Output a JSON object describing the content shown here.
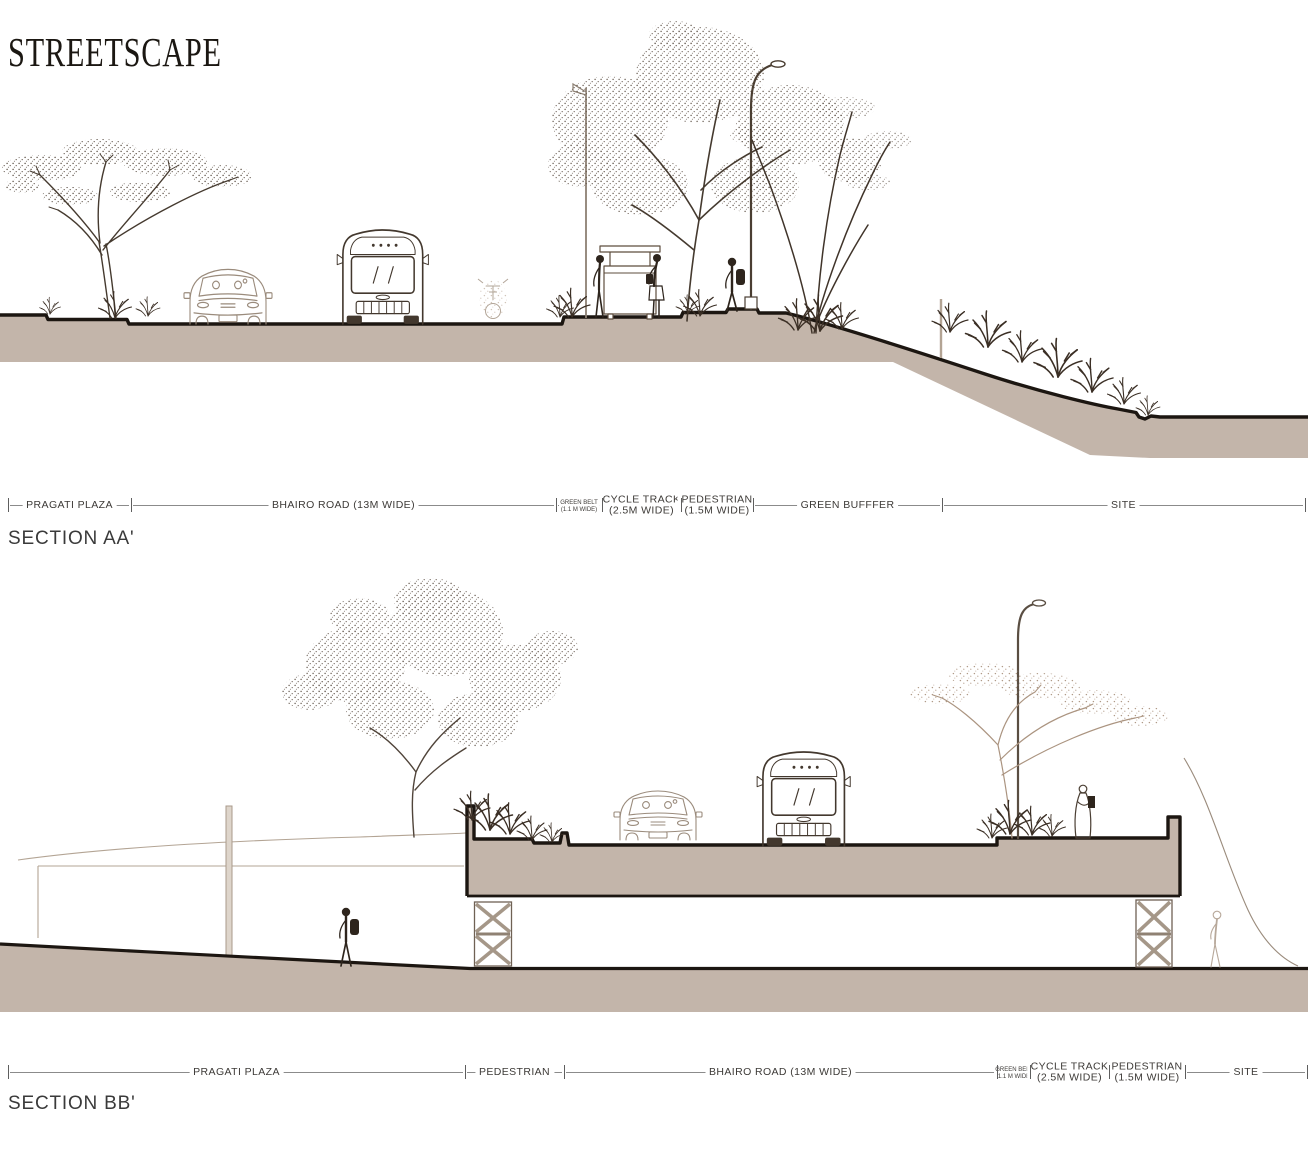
{
  "title": "STREETSCAPE",
  "palette": {
    "ground_fill": "#c3b5aa",
    "heavy_outline": "#1c1611",
    "sketch_dark": "#3b2f25",
    "sketch_light": "#b3a494",
    "label_text": "#3d3a37",
    "dim_line": "#8b8b8b"
  },
  "sections": [
    {
      "id": "AA",
      "heading": "SECTION AA'",
      "strip_y": 505,
      "segments": [
        {
          "label": "PRAGATI PLAZA",
          "x1": 8,
          "x2": 131
        },
        {
          "label": "BHAIRO ROAD (13M WIDE)",
          "x1": 131,
          "x2": 556
        },
        {
          "label": "GREEN BELT",
          "label2": "(1.1 M WIDE)",
          "size": "small",
          "x1": 556,
          "x2": 602
        },
        {
          "label": "CYCLE TRACK",
          "label2": "(2.5M WIDE)",
          "size": "two-line",
          "x1": 602,
          "x2": 681
        },
        {
          "label": "PEDESTRIAN",
          "label2": "(1.5M WIDE)",
          "size": "two-line",
          "x1": 681,
          "x2": 753
        },
        {
          "label": "GREEN BUFFFER",
          "x1": 753,
          "x2": 942
        },
        {
          "label": "SITE",
          "x1": 942,
          "x2": 1305
        }
      ]
    },
    {
      "id": "BB",
      "heading": "SECTION BB'",
      "strip_y": 1072,
      "segments": [
        {
          "label": "PRAGATI PLAZA",
          "x1": 8,
          "x2": 465
        },
        {
          "label": "PEDESTRIAN",
          "x1": 465,
          "x2": 564
        },
        {
          "label": "BHAIRO ROAD (13M WIDE)",
          "x1": 564,
          "x2": 997
        },
        {
          "label": "GREEN BELT",
          "label2": "1.1 M WIDE",
          "size": "small",
          "x1": 997,
          "x2": 1030
        },
        {
          "label": "CYCLE TRACK",
          "label2": "(2.5M WIDE)",
          "size": "two-line",
          "x1": 1030,
          "x2": 1109
        },
        {
          "label": "PEDESTRIAN",
          "label2": "(1.5M WIDE)",
          "size": "two-line",
          "x1": 1109,
          "x2": 1185
        },
        {
          "label": "SITE",
          "x1": 1185,
          "x2": 1307
        }
      ]
    }
  ]
}
